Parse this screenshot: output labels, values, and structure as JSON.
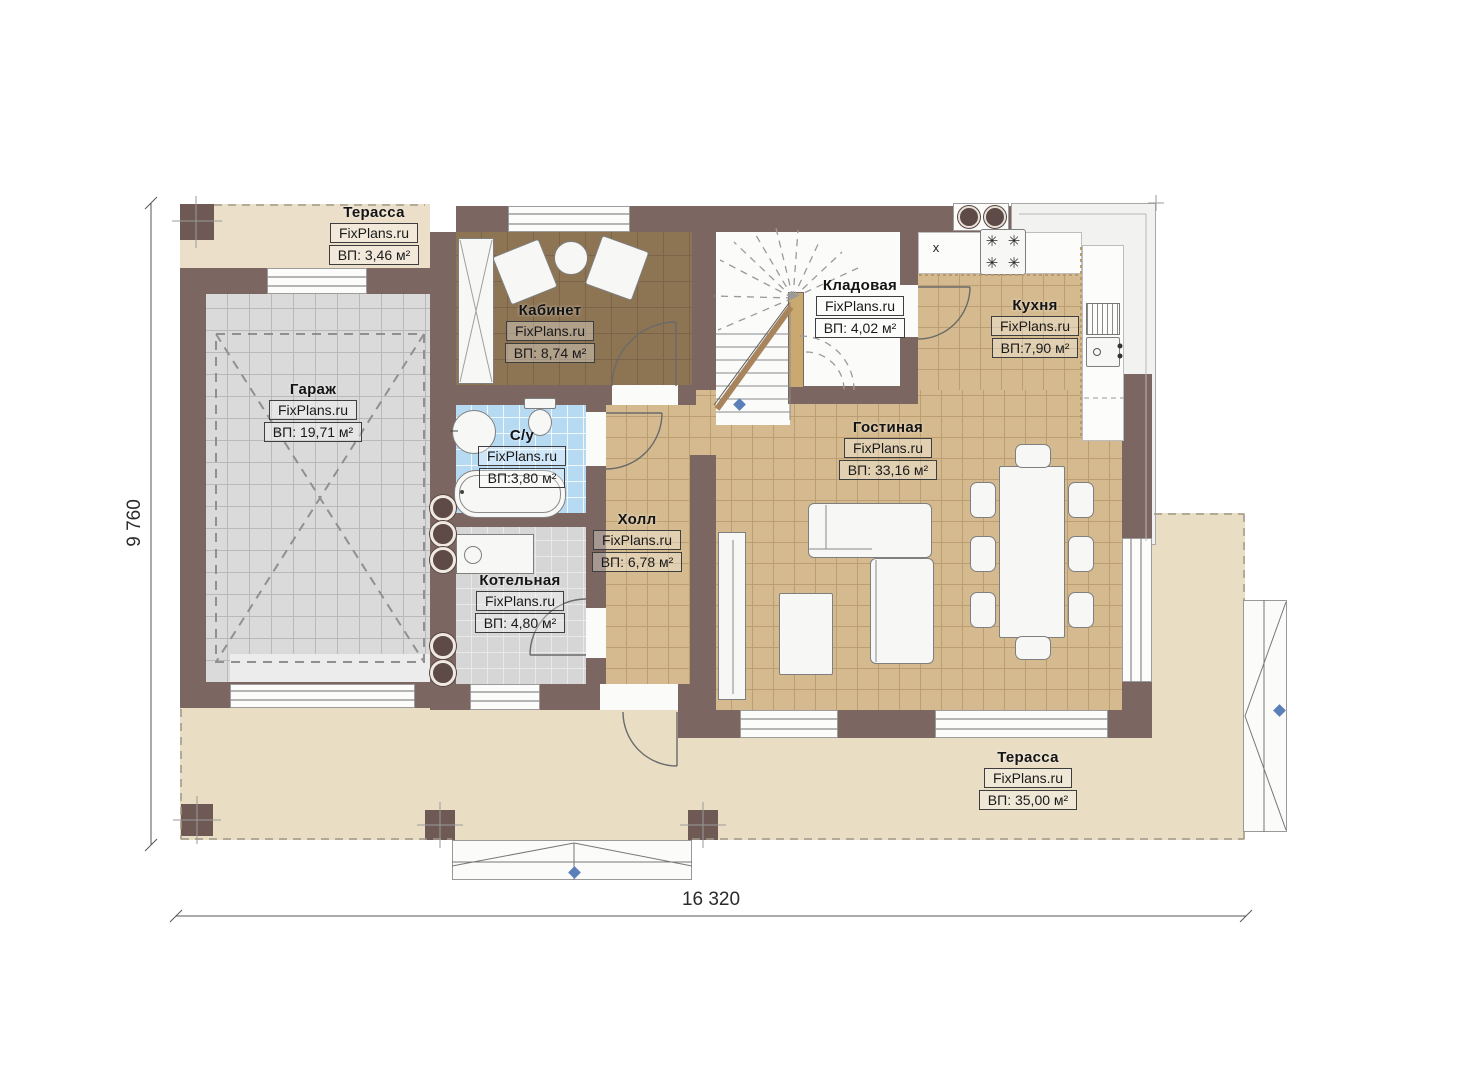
{
  "watermark": "FixPlans.ru",
  "dimensions": {
    "overall_width": "16 320",
    "overall_height": "9 760"
  },
  "annotations": {
    "kitchen_mark": "x"
  },
  "icons": {
    "burner": "✳"
  },
  "rooms": [
    {
      "id": "terrace-top",
      "name": "Терасса",
      "area": "ВП: 3,46 м²"
    },
    {
      "id": "garage",
      "name": "Гараж",
      "area": "ВП: 19,71 м²"
    },
    {
      "id": "office",
      "name": "Кабинет",
      "area": "ВП: 8,74 м²"
    },
    {
      "id": "bathroom",
      "name": "С/у",
      "area": "ВП:3,80 м²"
    },
    {
      "id": "boiler",
      "name": "Котельная",
      "area": "ВП: 4,80 м²"
    },
    {
      "id": "hall",
      "name": "Холл",
      "area": "ВП: 6,78 м²"
    },
    {
      "id": "storage",
      "name": "Кладовая",
      "area": "ВП: 4,02 м²"
    },
    {
      "id": "kitchen",
      "name": "Кухня",
      "area": "ВП:7,90 м²"
    },
    {
      "id": "living",
      "name": "Гостиная",
      "area": "ВП: 33,16 м²"
    },
    {
      "id": "terrace-bottom",
      "name": "Терасса",
      "area": "ВП: 35,00 м²"
    }
  ],
  "colors": {
    "wall": "#7c6661",
    "floor_tan": "#d4ba8e",
    "floor_garage": "#dadada",
    "floor_office": "#8d7453",
    "floor_bath": "#b7daf3",
    "floor_boiler": "#d6d6d6",
    "terrace": "#e9ddc4",
    "marker_blue": "#5b7fb9"
  }
}
